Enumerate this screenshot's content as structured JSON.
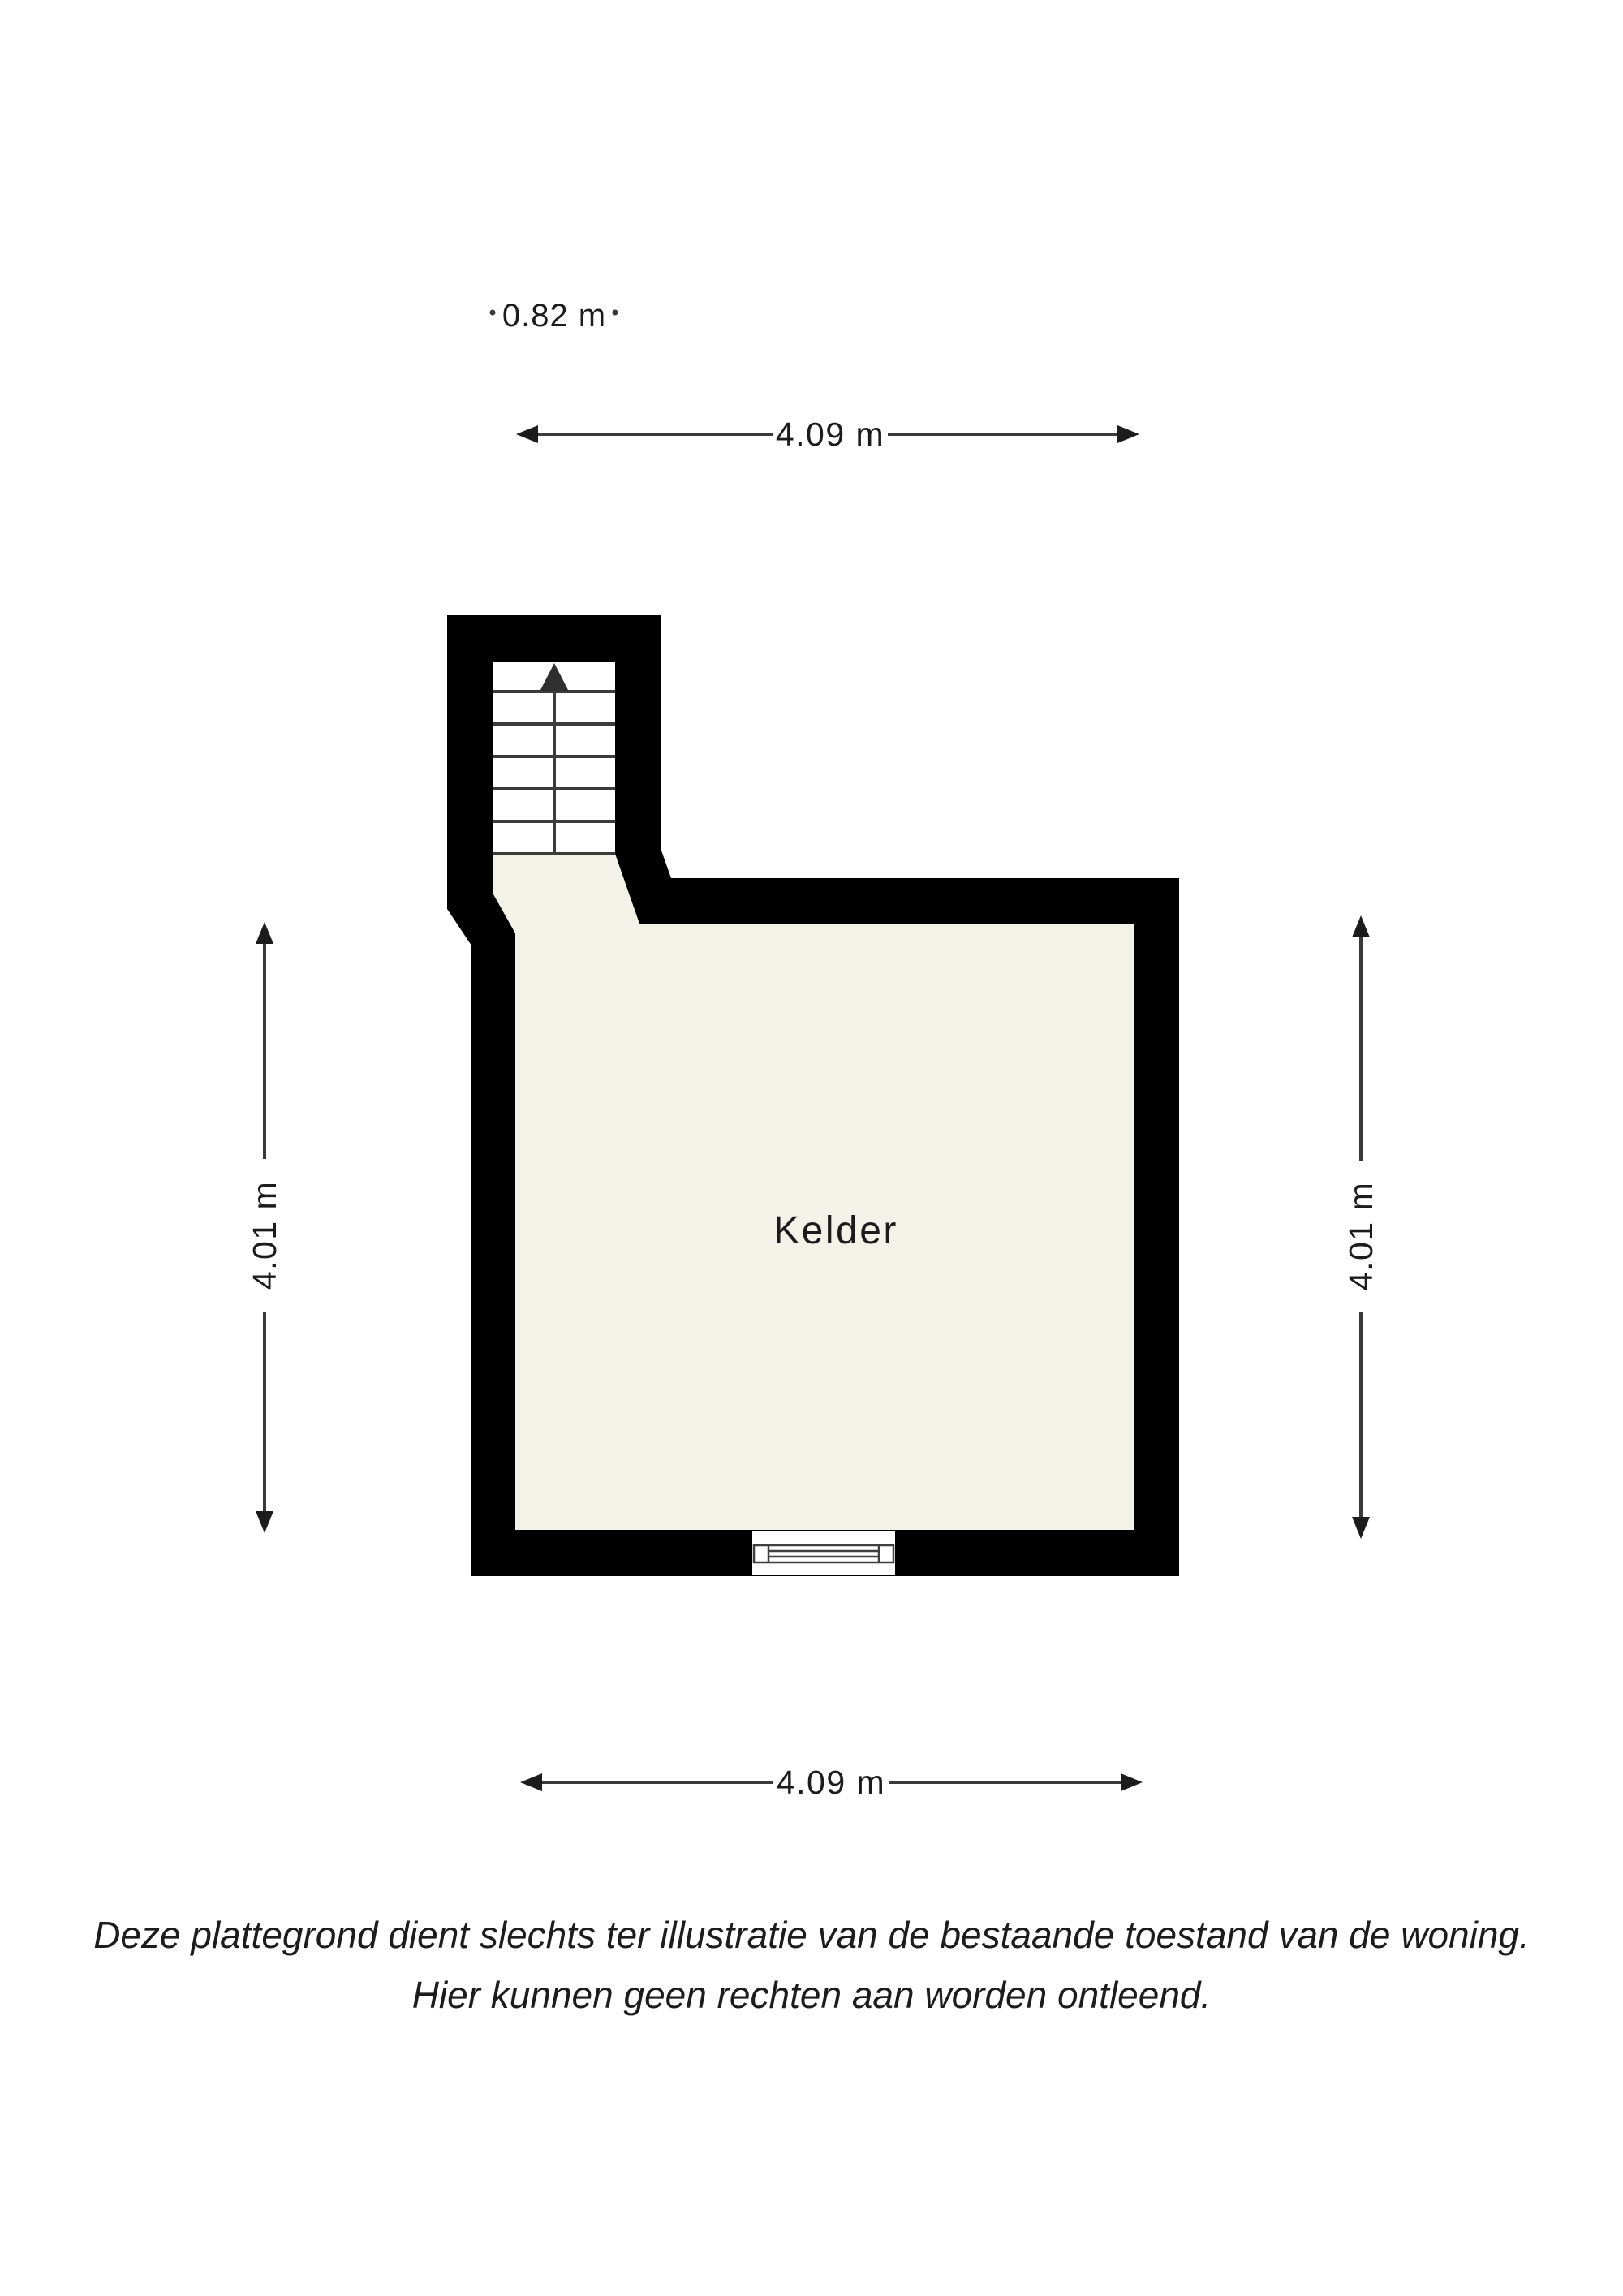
{
  "floorplan": {
    "room": {
      "label": "Kelder"
    },
    "dimensions": {
      "stair_width": {
        "label": "0.82 m"
      },
      "top_width": {
        "label": "4.09 m"
      },
      "left_height": {
        "label": "4.01 m"
      },
      "right_height": {
        "label": "4.01 m"
      },
      "bottom_width": {
        "label": "4.09 m"
      }
    },
    "disclaimer": {
      "line1": "Deze plattegrond dient slechts ter illustratie van de bestaande toestand van de woning.",
      "line2": "Hier kunnen geen rechten aan worden ontleend."
    },
    "colors": {
      "wall": "#000000",
      "floor": "#f3f2e9",
      "stairwell": "#ffffff",
      "dimension_line": "#3a3a3a",
      "text": "#1c1c1c"
    }
  }
}
